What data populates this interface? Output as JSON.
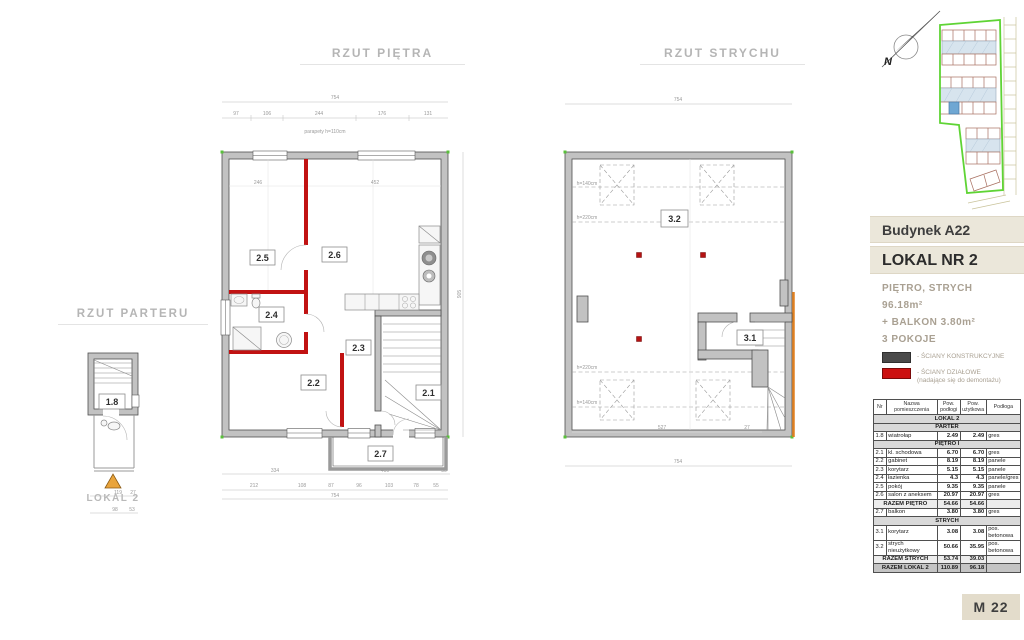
{
  "titles": {
    "parter": "RZUT PARTERU",
    "pietro": "RZUT PIĘTRA",
    "strych": "RZUT STRYCHU"
  },
  "colors": {
    "structural_wall": "#4a4a4a",
    "partition_wall": "#cc1111",
    "boundary_green": "#5fd435",
    "roof_blue": "#d7e4ee",
    "highlight_unit_blue": "#6fa7d3",
    "band_beige": "#ebe7da",
    "badge_beige": "#e3dccb",
    "entry_triangle_orange": "#e9a43c"
  },
  "site": {
    "north_label": "N"
  },
  "parter_plan": {
    "room": "1.8",
    "lokal": "LOKAL 2",
    "dims_row1": [
      "119",
      "27"
    ],
    "dims_row2": [
      "98",
      "53"
    ]
  },
  "pietro_plan": {
    "rooms": {
      "r21": "2.1",
      "r22": "2.2",
      "r23": "2.3",
      "r24": "2.4",
      "r25": "2.5",
      "r26": "2.6",
      "r27": "2.7"
    },
    "dim_top_total": "754",
    "dims_top": [
      "97",
      "106",
      "244",
      "176",
      "131"
    ],
    "inner_dims": [
      "246",
      "452"
    ],
    "dims_mid": [
      "334",
      "400",
      "30"
    ],
    "dims_bottom": [
      "212",
      "108",
      "87",
      "96",
      "103",
      "78",
      "55"
    ],
    "dim_bottom_total": "754",
    "dim_right": "905",
    "annotation": "parapety h=110cm"
  },
  "strych_plan": {
    "rooms": {
      "r31": "3.1",
      "r32": "3.2"
    },
    "dim_top": "754",
    "dim_bottom": "754",
    "inner_dims": [
      "527",
      "27"
    ],
    "h_lines": [
      "h=140cm",
      "h=220cm",
      "h=220cm",
      "h=140cm"
    ]
  },
  "panel": {
    "building": "Budynek A22",
    "lokal": "LOKAL NR 2",
    "floors": "PIĘTRO, STRYCH",
    "area": "96.18m²",
    "balcony": "+ BALKON 3.80m²",
    "rooms_count": "3 POKOJE",
    "legend": [
      {
        "label": "- ŚCIANY KONSTRUKCYJNE",
        "sub": ""
      },
      {
        "label": "- ŚCIANY DZIAŁOWE",
        "sub": "(nadające się do demontażu)"
      }
    ],
    "badge": "M 22"
  },
  "table": {
    "headers": {
      "nr": "Nr",
      "name": "Nazwa pomieszczenia",
      "floor_area": "Pow. podłogi",
      "usable_area": "Pow. użytkowa",
      "floor": "Podłoga"
    },
    "rows": [
      {
        "type": "section",
        "label": "LOKAL 2"
      },
      {
        "type": "section",
        "label": "PARTER"
      },
      {
        "type": "data",
        "nr": "1.8",
        "name": "wiatrołap",
        "a": "2.49",
        "b": "2.49",
        "floor": "gres"
      },
      {
        "type": "section",
        "label": "PIĘTRO I"
      },
      {
        "type": "data",
        "nr": "2.1",
        "name": "kl. schodowa",
        "a": "6.70",
        "b": "6.70",
        "floor": "gres"
      },
      {
        "type": "data",
        "nr": "2.2",
        "name": "gabinet",
        "a": "8.19",
        "b": "8.19",
        "floor": "panele"
      },
      {
        "type": "data",
        "nr": "2.3",
        "name": "korytarz",
        "a": "5.15",
        "b": "5.15",
        "floor": "panele"
      },
      {
        "type": "data",
        "nr": "2.4",
        "name": "łazienka",
        "a": "4.3",
        "b": "4.3",
        "floor": "panele/gres"
      },
      {
        "type": "data",
        "nr": "2.5",
        "name": "pokój",
        "a": "9.35",
        "b": "9.35",
        "floor": "panele"
      },
      {
        "type": "data",
        "nr": "2.6",
        "name": "salon z aneksem",
        "a": "20.97",
        "b": "20.97",
        "floor": "gres"
      },
      {
        "type": "sum",
        "label": "RAZEM PIĘTRO",
        "a": "54.66",
        "b": "54.66"
      },
      {
        "type": "data",
        "nr": "2.7",
        "name": "balkon",
        "a": "3.80",
        "b": "3.80",
        "floor": "gres"
      },
      {
        "type": "section",
        "label": "STRYCH"
      },
      {
        "type": "data",
        "nr": "3.1",
        "name": "korytarz",
        "a": "3.08",
        "b": "3.08",
        "floor": "pos. betonowa"
      },
      {
        "type": "data",
        "nr": "3.2",
        "name": "strych nieużytkowy",
        "a": "50.66",
        "b": "35.95",
        "floor": "pos. betonowa"
      },
      {
        "type": "sum",
        "label": "RAZEM STRYCH",
        "a": "53.74",
        "b": "39.03"
      },
      {
        "type": "total",
        "label": "RAZEM LOKAL 2",
        "a": "110.89",
        "b": "96.18"
      }
    ]
  }
}
